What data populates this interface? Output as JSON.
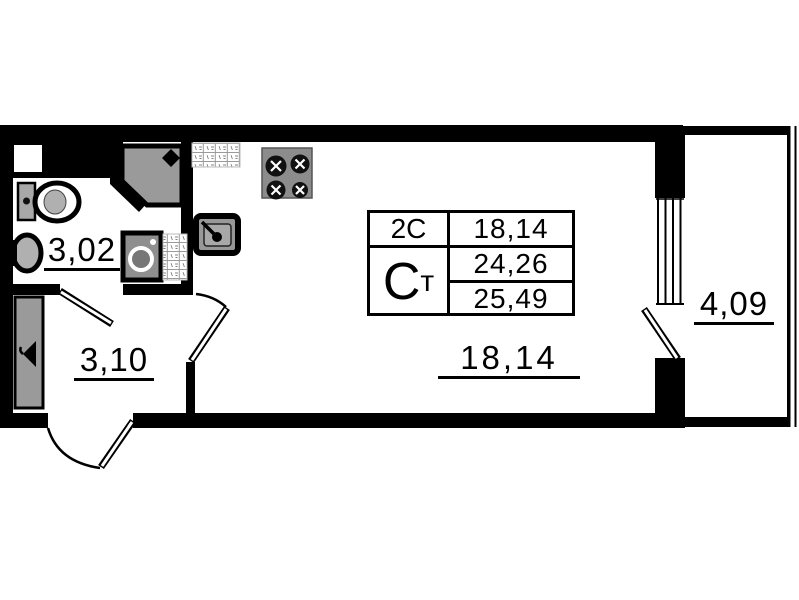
{
  "plan_type": "studio-apartment-floor-plan",
  "rooms": {
    "bathroom": "3,02",
    "hallway": "3,10",
    "living": "18,14",
    "balcony": "4,09"
  },
  "table": {
    "type_code": "2С",
    "living_area": "18,14",
    "studio_big": "С",
    "studio_small": "т",
    "area_no_balcony": "24,26",
    "total_area": "25,49"
  },
  "fixtures": [
    "shower-cabin-icon",
    "toilet-icon",
    "washbasin-icon",
    "washing-machine-icon",
    "towel-rail-hatch-icon",
    "kitchen-counter-hatch-icon",
    "kitchen-sink-icon",
    "stove-icon",
    "wardrobe-icon",
    "entrance-door-icon",
    "balcony-door-icon",
    "balcony-window-icon"
  ],
  "colors": {
    "wall": "#000000",
    "fixture_fill": "#9a9a9a",
    "background": "#ffffff"
  }
}
